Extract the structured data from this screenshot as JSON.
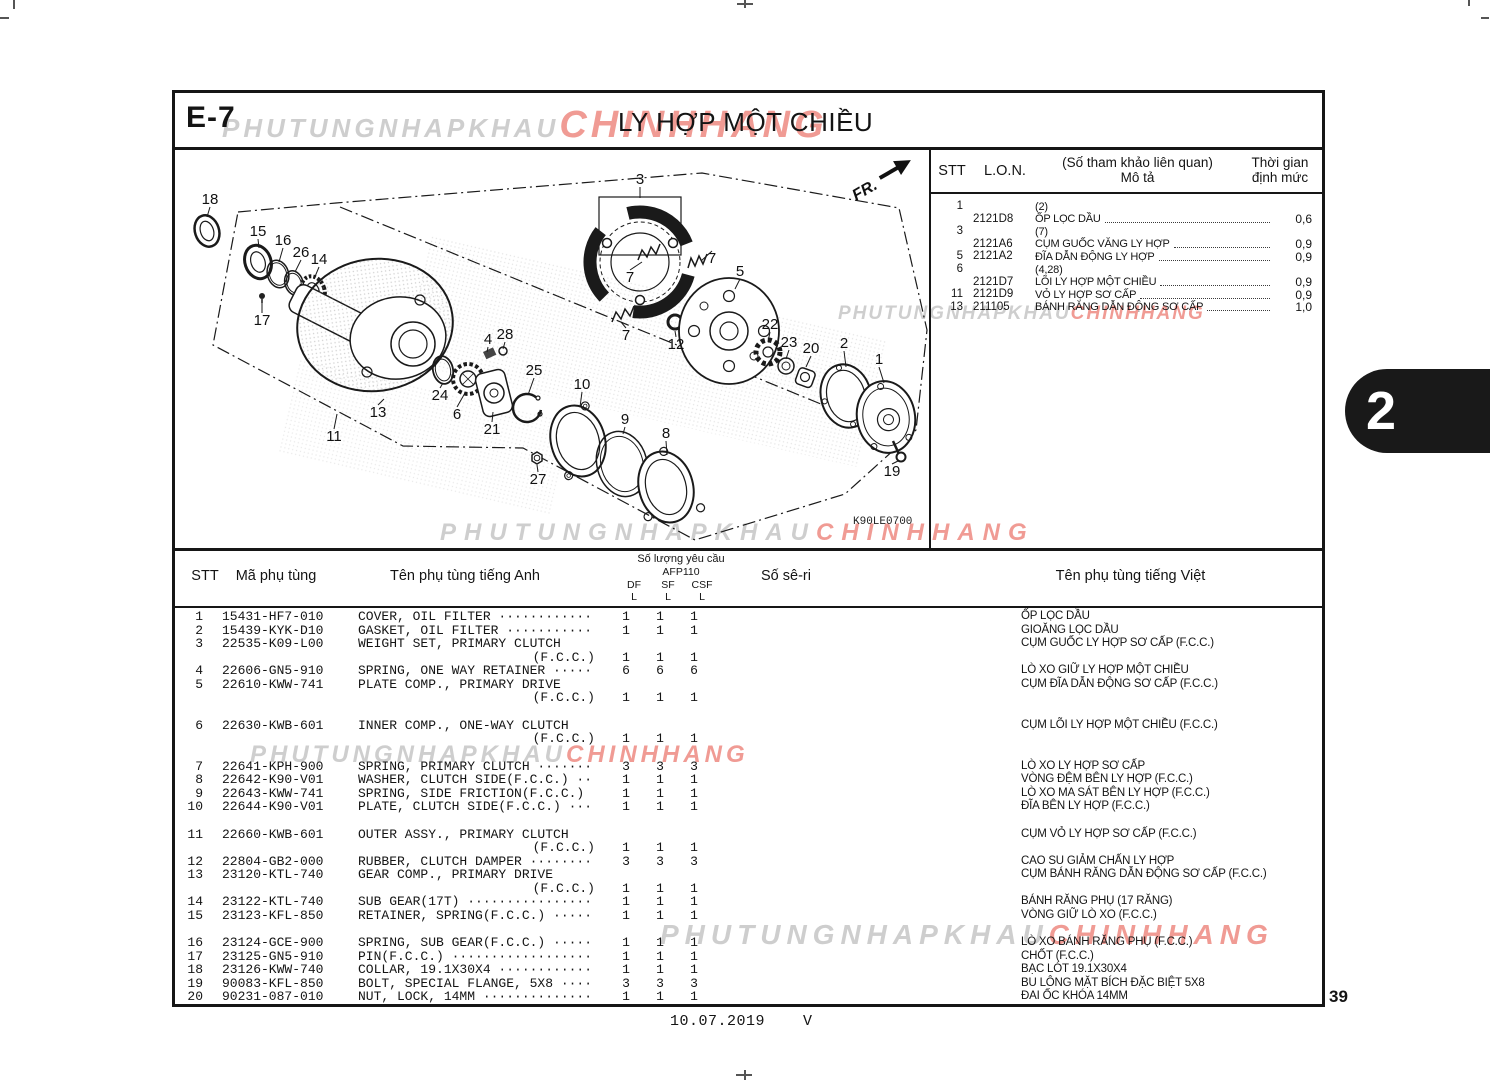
{
  "page": {
    "section_code": "E-7",
    "title": "LY HỢP MỘT CHIỀU",
    "page_number": "39",
    "footer_date": "10.07.2019",
    "footer_mark": "V",
    "side_tab": "2",
    "diagram_code": "K90LE0700",
    "fr_label": "FR."
  },
  "watermark": {
    "gray_text": "PHUTUNGNHAPKHAU",
    "red_text": "CHINHHANG",
    "gray_color": "#c6c6c6",
    "red_color": "#ee8a82",
    "instances": [
      {
        "x": 222,
        "y": 104,
        "gray_size": 26,
        "red_size": 38,
        "ls": 4
      },
      {
        "x": 838,
        "y": 303,
        "gray_size": 19,
        "red_size": 19,
        "ls": 2
      },
      {
        "x": 440,
        "y": 519,
        "gray_size": 24,
        "red_size": 24,
        "ls": 8
      },
      {
        "x": 250,
        "y": 741,
        "gray_size": 24,
        "red_size": 24,
        "ls": 4
      },
      {
        "x": 660,
        "y": 919,
        "gray_size": 28,
        "red_size": 28,
        "ls": 6
      }
    ]
  },
  "ref_table": {
    "headers": {
      "stt": "STT",
      "lon": "L.O.N.",
      "desc_line1": "(Số tham khảo liên quan)",
      "desc_line2": "Mô tả",
      "time_line1": "Thời gian",
      "time_line2": "định mức"
    },
    "rows": [
      {
        "stt": "1",
        "lon": "",
        "desc": "(2)",
        "time": ""
      },
      {
        "stt": "",
        "lon": "2121D8",
        "desc": "ỐP LỌC DẦU",
        "time": "0,6"
      },
      {
        "stt": "3",
        "lon": "",
        "desc": "(7)",
        "time": ""
      },
      {
        "stt": "",
        "lon": "2121A6",
        "desc": "CỤM GUỐC VĂNG LY HỢP",
        "time": "0,9"
      },
      {
        "stt": "5",
        "lon": "2121A2",
        "desc": "ĐĨA DẪN ĐỘNG LY HỢP",
        "time": "0,9"
      },
      {
        "stt": "6",
        "lon": "",
        "desc": "(4,28)",
        "time": ""
      },
      {
        "stt": "",
        "lon": "2121D7",
        "desc": "LÕI LY HỢP MỘT CHIỀU",
        "time": "0,9"
      },
      {
        "stt": "11",
        "lon": "2121D9",
        "desc": "VỎ LY HỢP SƠ CẤP",
        "time": "0,9"
      },
      {
        "stt": "13",
        "lon": "211105",
        "desc": "BÁNH RĂNG DẪN ĐỘNG SƠ CẤP",
        "time": "1,0"
      }
    ]
  },
  "parts_table": {
    "headers": {
      "stt": "STT",
      "code": "Mã phụ tùng",
      "name_en": "Tên phụ tùng tiếng Anh",
      "qty_group": "Số lượng yêu cầu",
      "qty_model": "AFP110",
      "qty_cols": [
        "DF",
        "SF",
        "CSF"
      ],
      "qty_sub": [
        "L",
        "L",
        "L"
      ],
      "serial": "Số sê-ri",
      "name_vn": "Tên phụ tùng tiếng Việt"
    },
    "rows": [
      {
        "stt": "1",
        "code": "15431-HF7-010",
        "name": "COVER, OIL FILTER ············",
        "name2": "",
        "qty": [
          "1",
          "1",
          "1"
        ],
        "vn": "ỐP LỌC DẦU",
        "gap": false
      },
      {
        "stt": "2",
        "code": "15439-KYK-D10",
        "name": "GASKET, OIL FILTER ···········",
        "name2": "",
        "qty": [
          "1",
          "1",
          "1"
        ],
        "vn": "GIOĂNG LỌC DẦU",
        "gap": false
      },
      {
        "stt": "3",
        "code": "22535-K09-L00",
        "name": "WEIGHT SET, PRIMARY CLUTCH",
        "name2": "(F.C.C.)",
        "qty": [
          "1",
          "1",
          "1"
        ],
        "vn": "CỤM GUỐC LY HỢP SƠ CẤP (F.C.C.)",
        "gap": false
      },
      {
        "stt": "4",
        "code": "22606-GN5-910",
        "name": "SPRING, ONE WAY RETAINER ·····",
        "name2": "",
        "qty": [
          "6",
          "6",
          "6"
        ],
        "vn": "LÒ XO GIỮ LY HỢP MỘT CHIỀU",
        "gap": false
      },
      {
        "stt": "5",
        "code": "22610-KWW-741",
        "name": "PLATE COMP., PRIMARY DRIVE",
        "name2": "(F.C.C.)",
        "qty": [
          "1",
          "1",
          "1"
        ],
        "vn": "CỤM ĐĨA DẪN ĐỘNG SƠ CẤP (F.C.C.)",
        "gap": false
      },
      {
        "stt": "6",
        "code": "22630-KWB-601",
        "name": "INNER COMP., ONE-WAY CLUTCH",
        "name2": "(F.C.C.)",
        "qty": [
          "1",
          "1",
          "1"
        ],
        "vn": "CỤM LÕI LY HỢP MỘT CHIỀU (F.C.C.)",
        "gap": true
      },
      {
        "stt": "7",
        "code": "22641-KPH-900",
        "name": "SPRING, PRIMARY CLUTCH ·······",
        "name2": "",
        "qty": [
          "3",
          "3",
          "3"
        ],
        "vn": "LÒ XO LY HỢP SƠ CẤP",
        "gap": true
      },
      {
        "stt": "8",
        "code": "22642-K90-V01",
        "name": "WASHER, CLUTCH SIDE(F.C.C.) ··",
        "name2": "",
        "qty": [
          "1",
          "1",
          "1"
        ],
        "vn": "VÒNG ĐỆM BÊN LY HỢP (F.C.C.)",
        "gap": false
      },
      {
        "stt": "9",
        "code": "22643-KWW-741",
        "name": "SPRING, SIDE FRICTION(F.C.C.)",
        "name2": "",
        "qty": [
          "1",
          "1",
          "1"
        ],
        "vn": "LÒ XO MA SÁT BÊN LY HỢP (F.C.C.)",
        "gap": false
      },
      {
        "stt": "10",
        "code": "22644-K90-V01",
        "name": "PLATE, CLUTCH SIDE(F.C.C.) ···",
        "name2": "",
        "qty": [
          "1",
          "1",
          "1"
        ],
        "vn": "ĐĨA BÊN LY HỢP (F.C.C.)",
        "gap": false
      },
      {
        "stt": "11",
        "code": "22660-KWB-601",
        "name": "OUTER ASSY., PRIMARY CLUTCH",
        "name2": "(F.C.C.)",
        "qty": [
          "1",
          "1",
          "1"
        ],
        "vn": "CỤM VỎ LY HỢP SƠ CẤP (F.C.C.)",
        "gap": true
      },
      {
        "stt": "12",
        "code": "22804-GB2-000",
        "name": "RUBBER, CLUTCH DAMPER ········",
        "name2": "",
        "qty": [
          "3",
          "3",
          "3"
        ],
        "vn": "CAO SU GIẢM CHẤN LY HỢP",
        "gap": false
      },
      {
        "stt": "13",
        "code": "23120-KTL-740",
        "name": "GEAR COMP., PRIMARY DRIVE",
        "name2": "(F.C.C.)",
        "qty": [
          "1",
          "1",
          "1"
        ],
        "vn": "CỤM BÁNH RĂNG DẪN ĐỘNG SƠ CẤP (F.C.C.)",
        "gap": false
      },
      {
        "stt": "14",
        "code": "23122-KTL-740",
        "name": "SUB GEAR(17T) ················",
        "name2": "",
        "qty": [
          "1",
          "1",
          "1"
        ],
        "vn": "BÁNH RĂNG PHỤ (17 RĂNG)",
        "gap": false
      },
      {
        "stt": "15",
        "code": "23123-KFL-850",
        "name": "RETAINER, SPRING(F.C.C.) ·····",
        "name2": "",
        "qty": [
          "1",
          "1",
          "1"
        ],
        "vn": "VÒNG GIỮ LÒ XO (F.C.C.)",
        "gap": false
      },
      {
        "stt": "16",
        "code": "23124-GCE-900",
        "name": "SPRING, SUB GEAR(F.C.C.) ·····",
        "name2": "",
        "qty": [
          "1",
          "1",
          "1"
        ],
        "vn": "LÒ XO BÁNH RĂNG PHỤ (F.C.C.)",
        "gap": true
      },
      {
        "stt": "17",
        "code": "23125-GN5-910",
        "name": "PIN(F.C.C.) ··················",
        "name2": "",
        "qty": [
          "1",
          "1",
          "1"
        ],
        "vn": "CHỐT (F.C.C.)",
        "gap": false
      },
      {
        "stt": "18",
        "code": "23126-KWW-740",
        "name": "COLLAR, 19.1X30X4 ············",
        "name2": "",
        "qty": [
          "1",
          "1",
          "1"
        ],
        "vn": "BẠC LÓT 19.1X30X4",
        "gap": false
      },
      {
        "stt": "19",
        "code": "90083-KFL-850",
        "name": "BOLT, SPECIAL FLANGE, 5X8 ····",
        "name2": "",
        "qty": [
          "3",
          "3",
          "3"
        ],
        "vn": "BU LÔNG MẶT BÍCH ĐẶC BIỆT 5X8",
        "gap": false
      },
      {
        "stt": "20",
        "code": "90231-087-010",
        "name": "NUT, LOCK, 14MM ··············",
        "name2": "",
        "qty": [
          "1",
          "1",
          "1"
        ],
        "vn": "ĐAI ỐC KHÓA 14MM",
        "gap": false
      }
    ]
  },
  "diagram": {
    "callouts": [
      {
        "n": "18",
        "x": 210,
        "y": 204,
        "tx": 207,
        "ty": 217
      },
      {
        "n": "15",
        "x": 258,
        "y": 236,
        "tx": 259,
        "ty": 248
      },
      {
        "n": "16",
        "x": 283,
        "y": 245,
        "tx": 279,
        "ty": 262
      },
      {
        "n": "26",
        "x": 301,
        "y": 257,
        "tx": 295,
        "ty": 272
      },
      {
        "n": "14",
        "x": 319,
        "y": 264,
        "tx": 314,
        "ty": 279
      },
      {
        "n": "17",
        "x": 262,
        "y": 325,
        "tx": 262,
        "ty": 301
      },
      {
        "n": "3",
        "x": 640,
        "y": 184,
        "tx": 640,
        "ty": 198
      },
      {
        "n": "7",
        "x": 712,
        "y": 263,
        "tx": 701,
        "ty": 261
      },
      {
        "n": "7",
        "x": 630,
        "y": 282,
        "tx": 642,
        "ty": 262
      },
      {
        "n": "7",
        "x": 626,
        "y": 340,
        "tx": 621,
        "ty": 322
      },
      {
        "n": "5",
        "x": 740,
        "y": 276,
        "tx": 735,
        "ty": 289
      },
      {
        "n": "12",
        "x": 676,
        "y": 349,
        "tx": 675,
        "ty": 331
      },
      {
        "n": "22",
        "x": 770,
        "y": 329,
        "tx": 768,
        "ty": 342
      },
      {
        "n": "23",
        "x": 789,
        "y": 347,
        "tx": 786,
        "ty": 359
      },
      {
        "n": "20",
        "x": 811,
        "y": 353,
        "tx": 806,
        "ty": 367
      },
      {
        "n": "2",
        "x": 844,
        "y": 348,
        "tx": 846,
        "ty": 367
      },
      {
        "n": "1",
        "x": 879,
        "y": 364,
        "tx": 884,
        "ty": 383
      },
      {
        "n": "19",
        "x": 892,
        "y": 476,
        "tx": 898,
        "ty": 461
      },
      {
        "n": "10",
        "x": 582,
        "y": 389,
        "tx": 580,
        "ty": 407
      },
      {
        "n": "9",
        "x": 625,
        "y": 424,
        "tx": 623,
        "ty": 434
      },
      {
        "n": "8",
        "x": 666,
        "y": 438,
        "tx": 667,
        "ty": 455
      },
      {
        "n": "4",
        "x": 488,
        "y": 344,
        "tx": 487,
        "ty": 352
      },
      {
        "n": "28",
        "x": 505,
        "y": 339,
        "tx": 503,
        "ty": 349
      },
      {
        "n": "24",
        "x": 440,
        "y": 400,
        "tx": 443,
        "ty": 383
      },
      {
        "n": "6",
        "x": 457,
        "y": 419,
        "tx": 465,
        "ty": 393
      },
      {
        "n": "21",
        "x": 492,
        "y": 434,
        "tx": 493,
        "ty": 412
      },
      {
        "n": "25",
        "x": 534,
        "y": 375,
        "tx": 528,
        "ty": 395
      },
      {
        "n": "13",
        "x": 378,
        "y": 417,
        "tx": 384,
        "ty": 399
      },
      {
        "n": "11",
        "x": 334,
        "y": 441,
        "tx": 337,
        "ty": 414
      },
      {
        "n": "27",
        "x": 538,
        "y": 484,
        "tx": 537,
        "ty": 465
      }
    ]
  }
}
